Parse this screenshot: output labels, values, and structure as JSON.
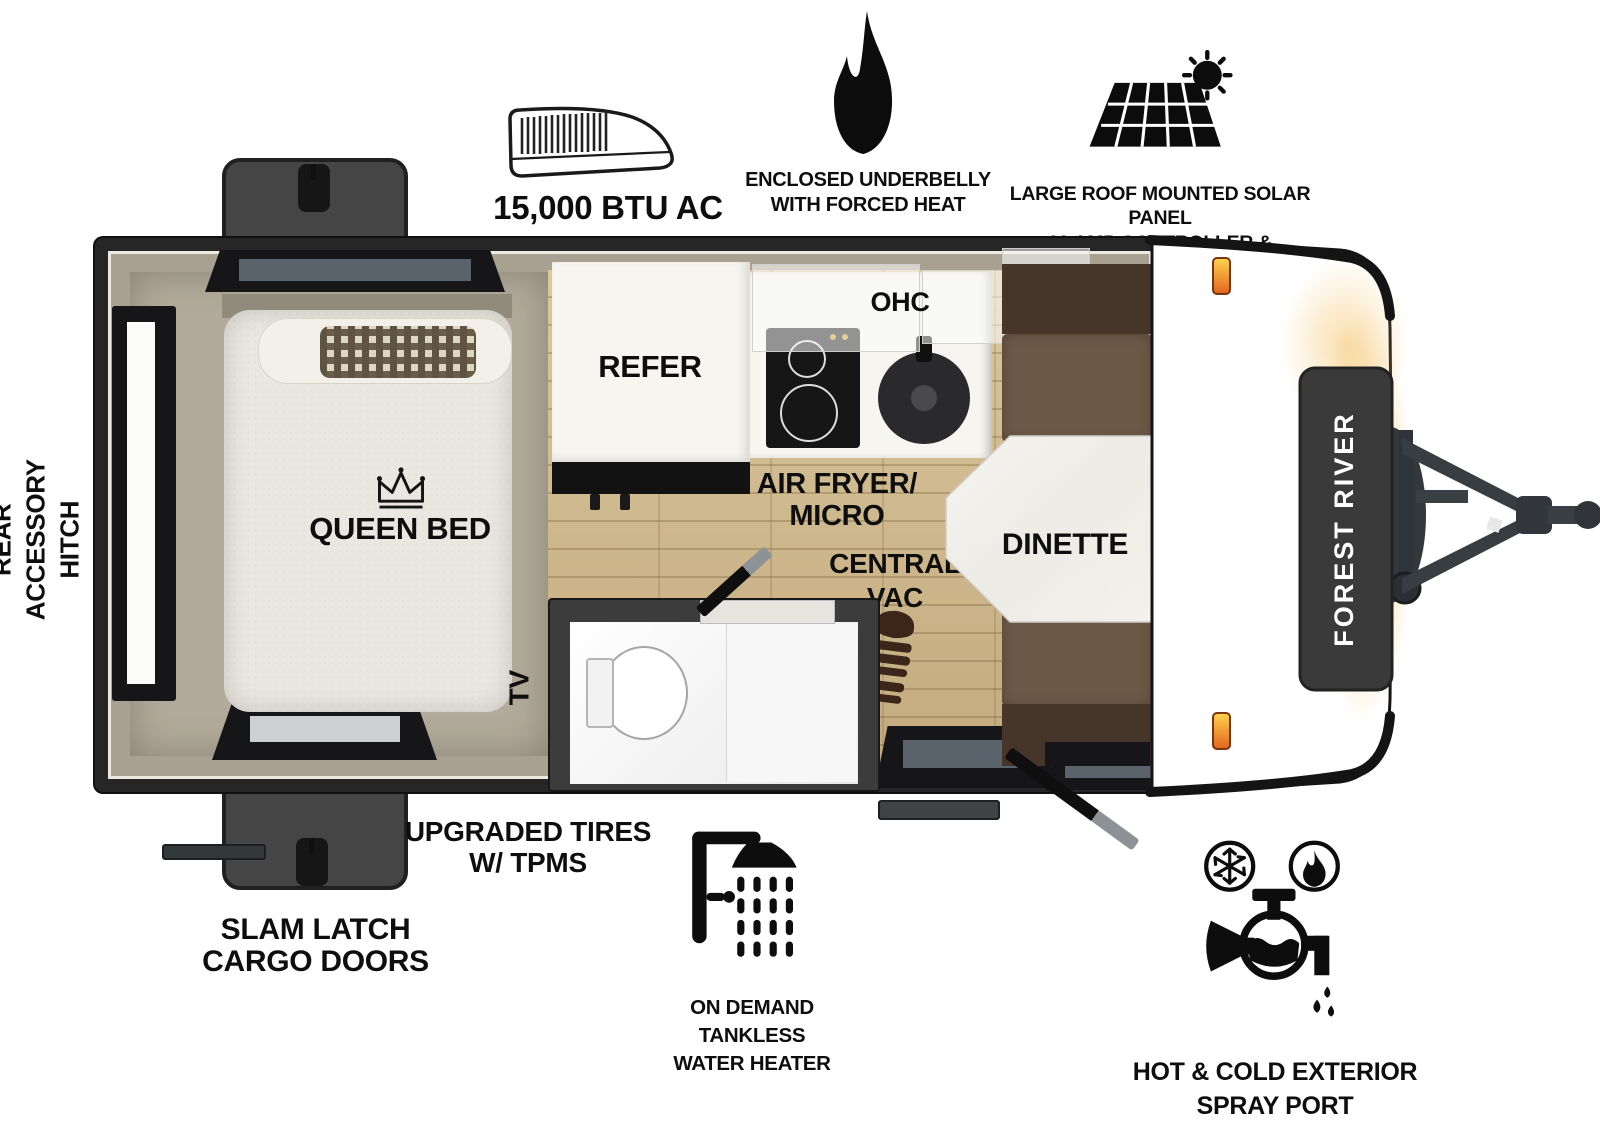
{
  "title": "Forest River travel trailer floor plan",
  "brand": {
    "name": "FOREST RIVER"
  },
  "colors": {
    "wall_dark": "#262626",
    "wood_floor": "#d3bd93",
    "bench_brown": "#6d5948",
    "marker_orange": "#f59b2d",
    "cap_glow": "#f3bc55"
  },
  "callouts": {
    "ac": {
      "label": "15,000 BTU AC",
      "icon": "rooftop-ac-icon"
    },
    "underbelly": {
      "line1": "ENCLOSED UNDERBELLY",
      "line2": "WITH FORCED HEAT",
      "icon": "flame-icon"
    },
    "solar": {
      "line1": "LARGE ROOF MOUNTED SOLAR PANEL",
      "line2": "30 AMP CONTROLLER & INVERTER PREP",
      "icon": "solar-panel-icon"
    },
    "rear_hitch": {
      "line1": "REAR",
      "line2": "ACCESSORY",
      "line3": "HITCH"
    },
    "cargo_doors": {
      "line1": "SLAM LATCH",
      "line2": "CARGO DOORS"
    },
    "tires": {
      "line1": "UPGRADED TIRES",
      "line2": "W/ TPMS"
    },
    "water_heater": {
      "line1": "ON DEMAND",
      "line2": "TANKLESS",
      "line3": "WATER HEATER",
      "icon": "shower-icon"
    },
    "spray_port": {
      "line1": "HOT & COLD EXTERIOR",
      "line2": "SPRAY PORT",
      "icon": "spray-port-icon"
    }
  },
  "rooms": {
    "bed": "QUEEN BED",
    "refrigerator": "REFER",
    "overhead_cabinet": "OHC",
    "air_fryer_line1": "AIR FRYER/",
    "air_fryer_line2": "MICRO",
    "central_vac_line1": "CENTRAL",
    "central_vac_line2": "VAC",
    "dinette": "DINETTE",
    "tv": "TV"
  }
}
